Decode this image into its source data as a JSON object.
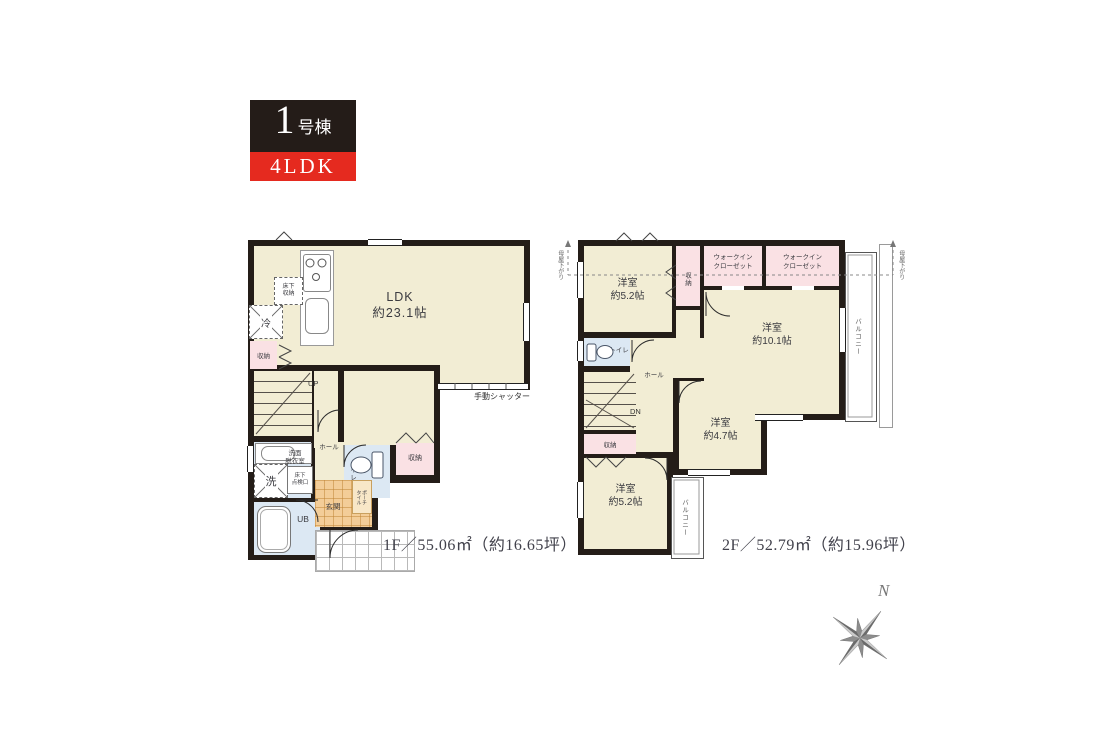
{
  "unit_badge": {
    "number": "1",
    "number_suffix": "号棟",
    "layout_type": "4LDK"
  },
  "colors": {
    "accent_red": "#e52a1f",
    "wall_black": "#241d18",
    "room_beige": "#f2edd4",
    "closet_pink": "#fae1e4",
    "wet_area_blue": "#dce8f3",
    "entry_tile_orange": "#f3cd98",
    "compass_gray": "#8d8d8d"
  },
  "floor1": {
    "summary": "1F／55.06㎡（約16.65坪）",
    "labels": {
      "ldk": "LDK\n約23.1帖",
      "underfloor_storage": "床下\n収納",
      "fridge": "冷",
      "closet_left": "収納",
      "stairs_up": "UP",
      "manual_shutter": "手動シャッター",
      "washroom": "洗面\n脱衣室",
      "washer": "洗",
      "underfloor_access": "床下\n点検口",
      "hall": "ホール",
      "toilet": "トイレ",
      "closet_hall": "収納",
      "unit_bath": "UB",
      "entry": "玄関",
      "porch_tile": "ポーチ\nタイル"
    }
  },
  "floor2": {
    "summary": "2F／52.79㎡（約15.96坪）",
    "labels": {
      "bedroom_nw": "洋室\n約5.2帖",
      "closet_strip": "収納",
      "wic_left": "ウォークイン\nクローゼット",
      "wic_right": "ウォークイン\nクローゼット",
      "bedroom_east": "洋室\n約10.1帖",
      "toilet": "トイレ",
      "hall": "ホール",
      "stairs_down": "DN",
      "closet_sw": "収納",
      "bedroom_mid": "洋室\n約4.7帖",
      "bedroom_sw": "洋室\n約5.2帖",
      "balcony_east": "バルコニー",
      "balcony_south": "バルコニー",
      "roof_slope_left": "母屋下がり",
      "roof_slope_right": "母屋下がり"
    }
  },
  "compass": {
    "north_label": "N"
  }
}
